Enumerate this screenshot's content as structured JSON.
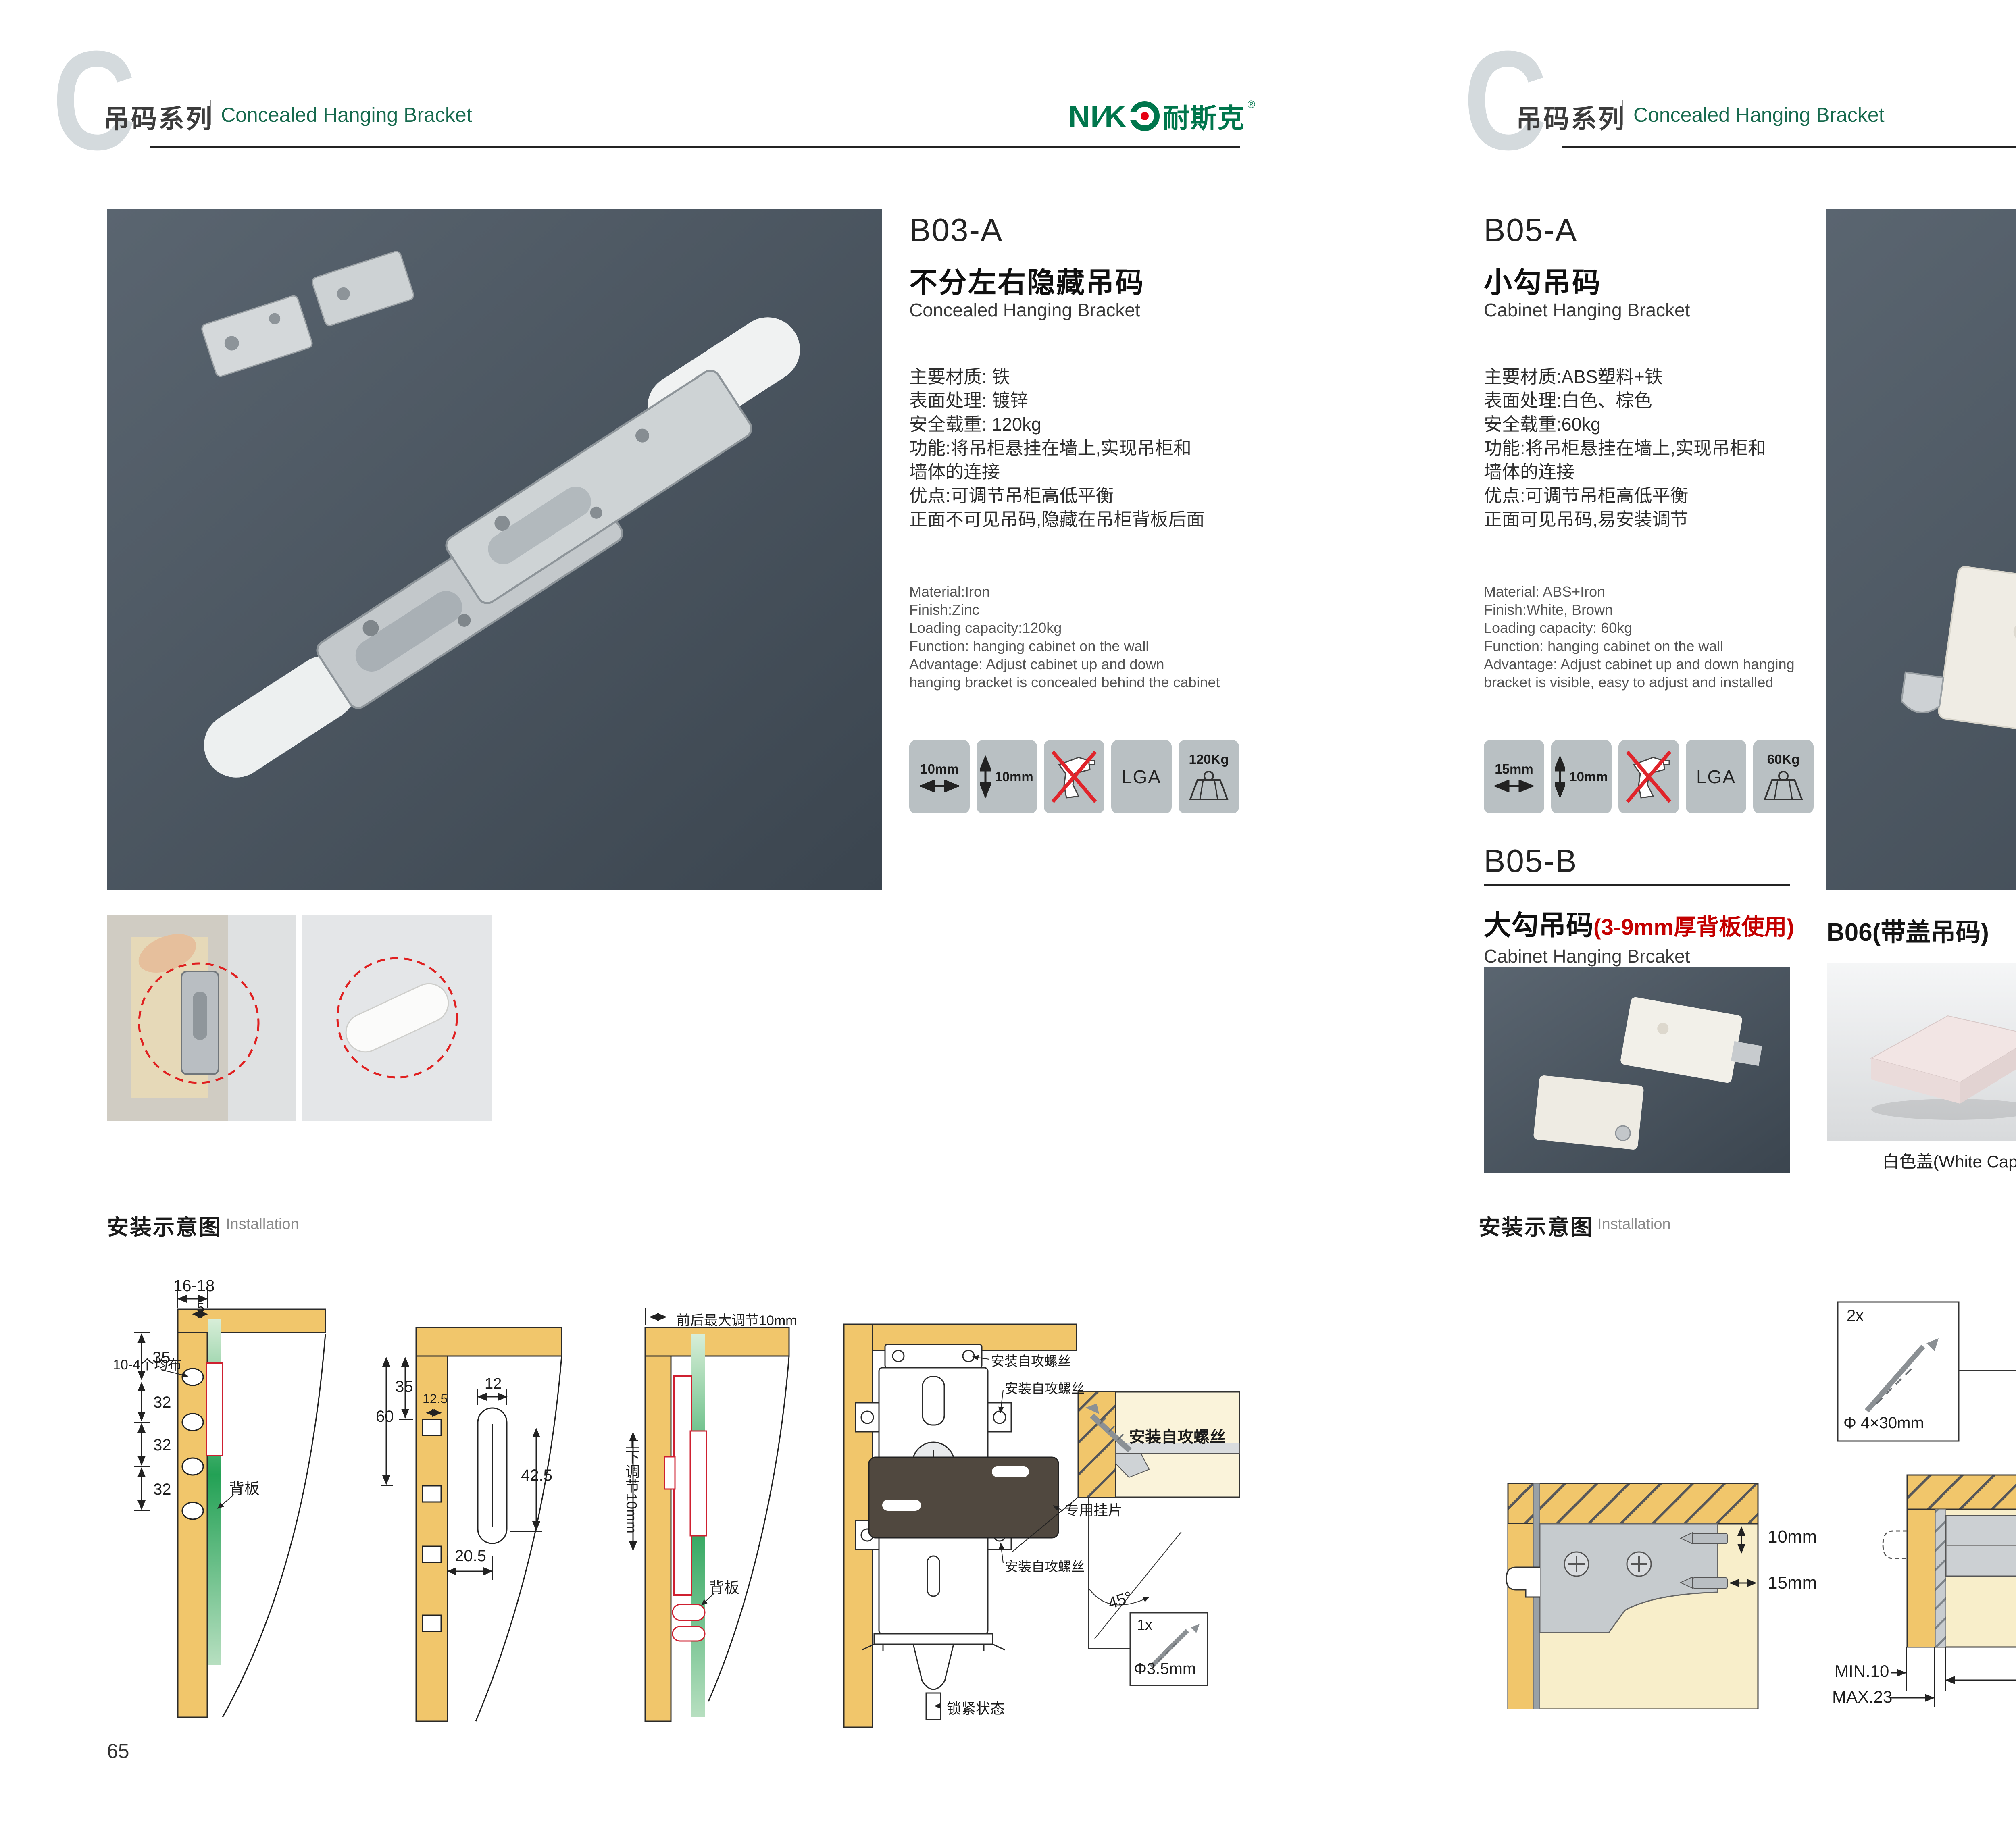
{
  "colors": {
    "accent_green": "#176a4e",
    "brand_green": "#00764c",
    "brand_dot_red": "#e60012",
    "note_red": "#c40000",
    "wood": "#f1c66b",
    "photo_slate": "#4a545f",
    "diagram_red": "#cf2030",
    "backboard_green": "#23a155"
  },
  "header": {
    "letter": "C",
    "series_cn": "吊码系列",
    "series_en": "Concealed Hanging Bracket",
    "brand": {
      "latin_left": "NI",
      "slash": "∕",
      "latin_right": "K",
      "cn": "耐斯克",
      "reg": "®"
    }
  },
  "page65": {
    "number": "65",
    "product": {
      "code": "B03-A",
      "name_cn": "不分左右隐藏吊码",
      "name_en": "Concealed Hanging Bracket",
      "specs_cn": [
        "主要材质: 铁",
        "表面处理: 镀锌",
        "安全载重: 120kg",
        "功能:将吊柜悬挂在墙上,实现吊柜和",
        "墙体的连接",
        "优点:可调节吊柜高低平衡",
        "正面不可见吊码,隐藏在吊柜背板后面"
      ],
      "specs_en": [
        "Material:Iron",
        "Finish:Zinc",
        "Loading capacity:120kg",
        "Function: hanging cabinet on the wall",
        "Advantage: Adjust cabinet up and down",
        "hanging bracket is concealed behind the cabinet"
      ],
      "icons": {
        "w": "10mm",
        "h": "10mm",
        "lga": "LGA",
        "load": "120Kg"
      }
    },
    "install": {
      "title_cn": "安装示意图",
      "title_en": "Installation",
      "d1": {
        "top": "16-18",
        "small": "5",
        "v1": "35",
        "v2": "32",
        "v3": "32",
        "v4": "32",
        "holes": "10-4个均布",
        "back": "背板"
      },
      "d2": {
        "a": "60",
        "b": "35",
        "c": "12.5",
        "d": "12",
        "e": "42.5",
        "f": "20.5"
      },
      "d3": {
        "top": "前后最大调节10mm",
        "side": "上下调节10mm",
        "back": "背板"
      },
      "d4": {
        "s1": "安装自攻螺丝",
        "s2": "安装自攻螺丝",
        "s3": "安装自攻螺丝",
        "plate": "专用挂片",
        "lock": "锁紧状态",
        "detail": "安装自攻螺丝",
        "angle": "45°",
        "qty": "1x",
        "dia": "Φ3.5mm"
      }
    }
  },
  "page66": {
    "number": "66",
    "product_a": {
      "code": "B05-A",
      "name_cn": "小勾吊码",
      "name_en": "Cabinet Hanging Bracket",
      "specs_cn": [
        "主要材质:ABS塑料+铁",
        "表面处理:白色、棕色",
        "安全载重:60kg",
        "功能:将吊柜悬挂在墙上,实现吊柜和",
        "墙体的连接",
        "优点:可调节吊柜高低平衡",
        "正面可见吊码,易安装调节"
      ],
      "specs_en": [
        "Material: ABS+Iron",
        "Finish:White, Brown",
        "Loading capacity: 60kg",
        "Function: hanging cabinet on the wall",
        "Advantage: Adjust cabinet up and down hanging",
        "bracket is visible, easy to adjust and installed"
      ],
      "icons": {
        "w": "15mm",
        "h": "10mm",
        "lga": "LGA",
        "load": "60Kg"
      }
    },
    "product_b": {
      "code": "B05-B",
      "name_cn": "大勾吊码",
      "name_note": "(3-9mm厚背板使用)",
      "name_en": "Cabinet Hanging Brcaket"
    },
    "product_c": {
      "title": "B06(带盖吊码)",
      "caps": [
        {
          "label": "白色盖(White Cap)"
        },
        {
          "label": "灰色盖(Gray Cap)"
        },
        {
          "label": "银色盖(Silver Cap)"
        }
      ]
    },
    "install": {
      "title_cn": "安装示意图",
      "title_en": "Installation",
      "r1": {
        "v": "10mm",
        "h": "15mm"
      },
      "r2": {
        "qty": "2x",
        "dia": "Φ 4×30mm",
        "t": "18",
        "min": "MIN.10",
        "max": "MAX.23",
        "w": "58"
      },
      "r3": {
        "a": "16",
        "b": "42",
        "r": "RMAX4",
        "c": "16",
        "d": "17",
        "e": "32"
      }
    }
  }
}
